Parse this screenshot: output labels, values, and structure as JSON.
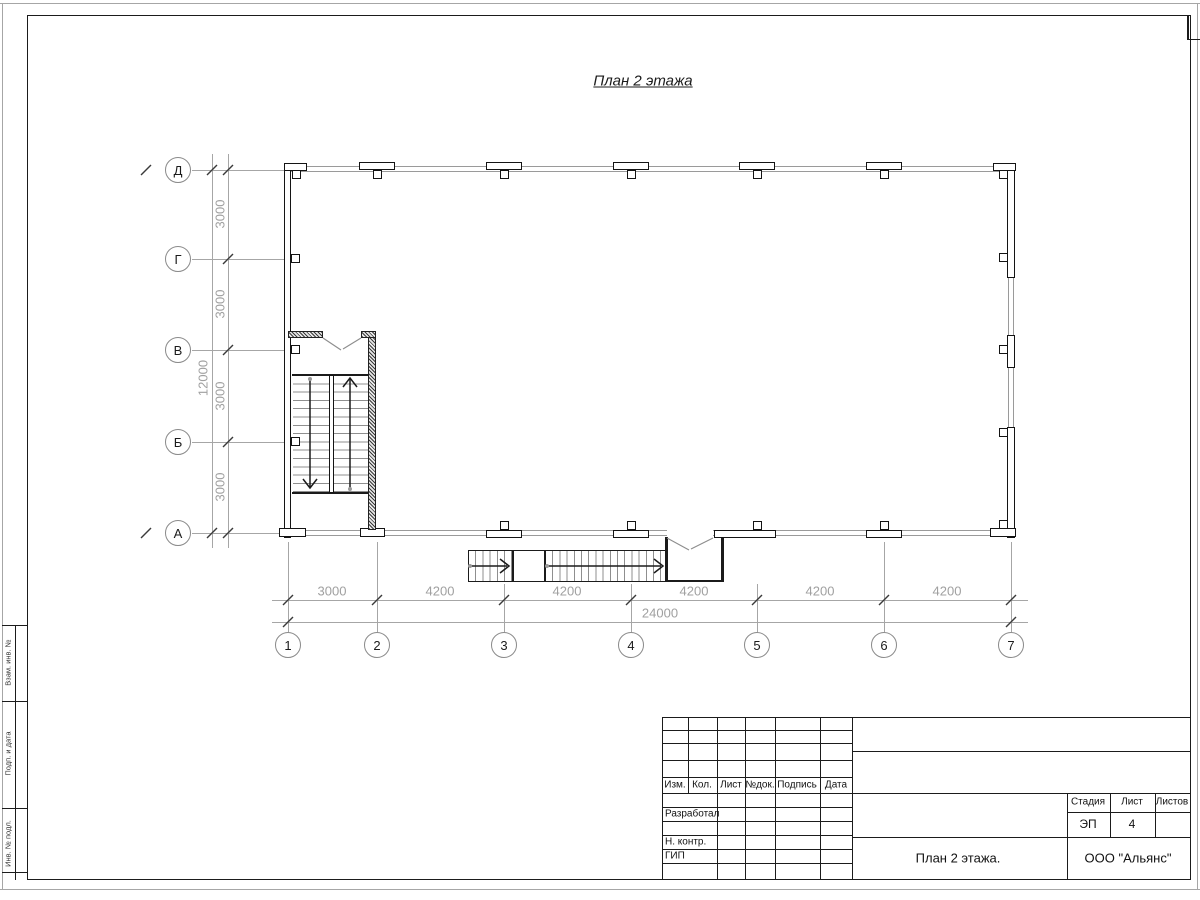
{
  "sheet": {
    "title": "План 2 этажа"
  },
  "plan": {
    "axes_vertical": [
      "Д",
      "Г",
      "В",
      "Б",
      "А"
    ],
    "axes_horizontal": [
      "1",
      "2",
      "3",
      "4",
      "5",
      "6",
      "7"
    ],
    "dims_bottom": [
      "3000",
      "4200",
      "4200",
      "4200",
      "4200",
      "4200"
    ],
    "dim_bottom_total": "24000",
    "dims_left": [
      "3000",
      "3000",
      "3000",
      "3000"
    ],
    "dim_left_total": "12000"
  },
  "side_stamp": {
    "cells": [
      "Взам. инв. №",
      "Подп. и дата",
      "Инв. № подл."
    ]
  },
  "title_block": {
    "header_cols": [
      "Изм.",
      "Кол.",
      "Лист",
      "№док.",
      "Подпись",
      "Дата"
    ],
    "row_labels": [
      "Разработал",
      "Н. контр.",
      "ГИП"
    ],
    "stage_label": "Стадия",
    "sheet_label": "Лист",
    "sheets_label": "Листов",
    "stage_value": "ЭП",
    "sheet_value": "4",
    "sheets_value": "",
    "doc_title": "План 2 этажа.",
    "company": "ООО \"Альянс\""
  },
  "colors": {
    "line": "#1b1b1b",
    "dim_text": "#a0a0a0"
  }
}
